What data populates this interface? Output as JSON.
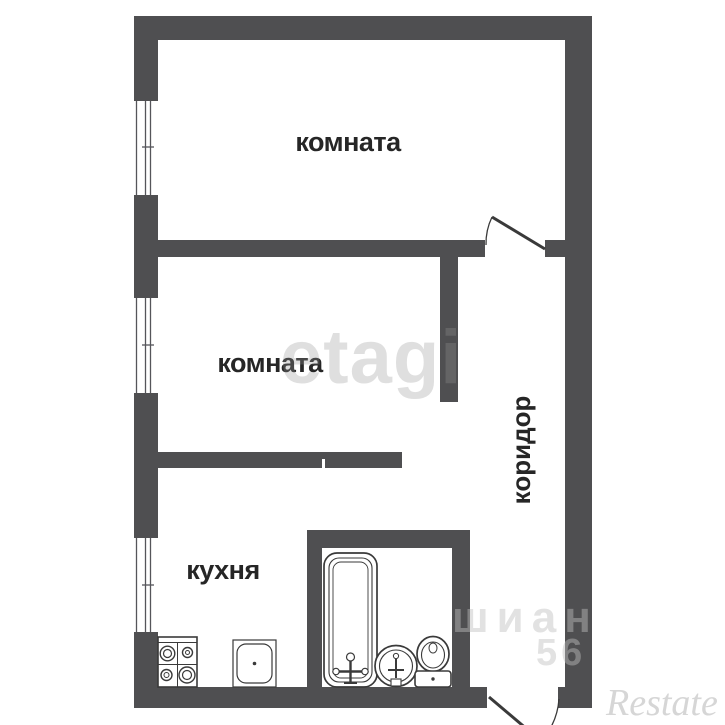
{
  "plan": {
    "labels": {
      "room_top": "комната",
      "room_middle": "комната",
      "kitchen": "кухня",
      "corridor": "коридор"
    },
    "colors": {
      "wall": "#4f4f51",
      "background": "#ffffff",
      "label": "#262626",
      "fixture_stroke": "#3a3a3a"
    }
  },
  "watermarks": {
    "brand_center": "etagi",
    "brand_right_top": "шиан",
    "brand_right_bottom": "56",
    "brand_corner": "Restate"
  }
}
